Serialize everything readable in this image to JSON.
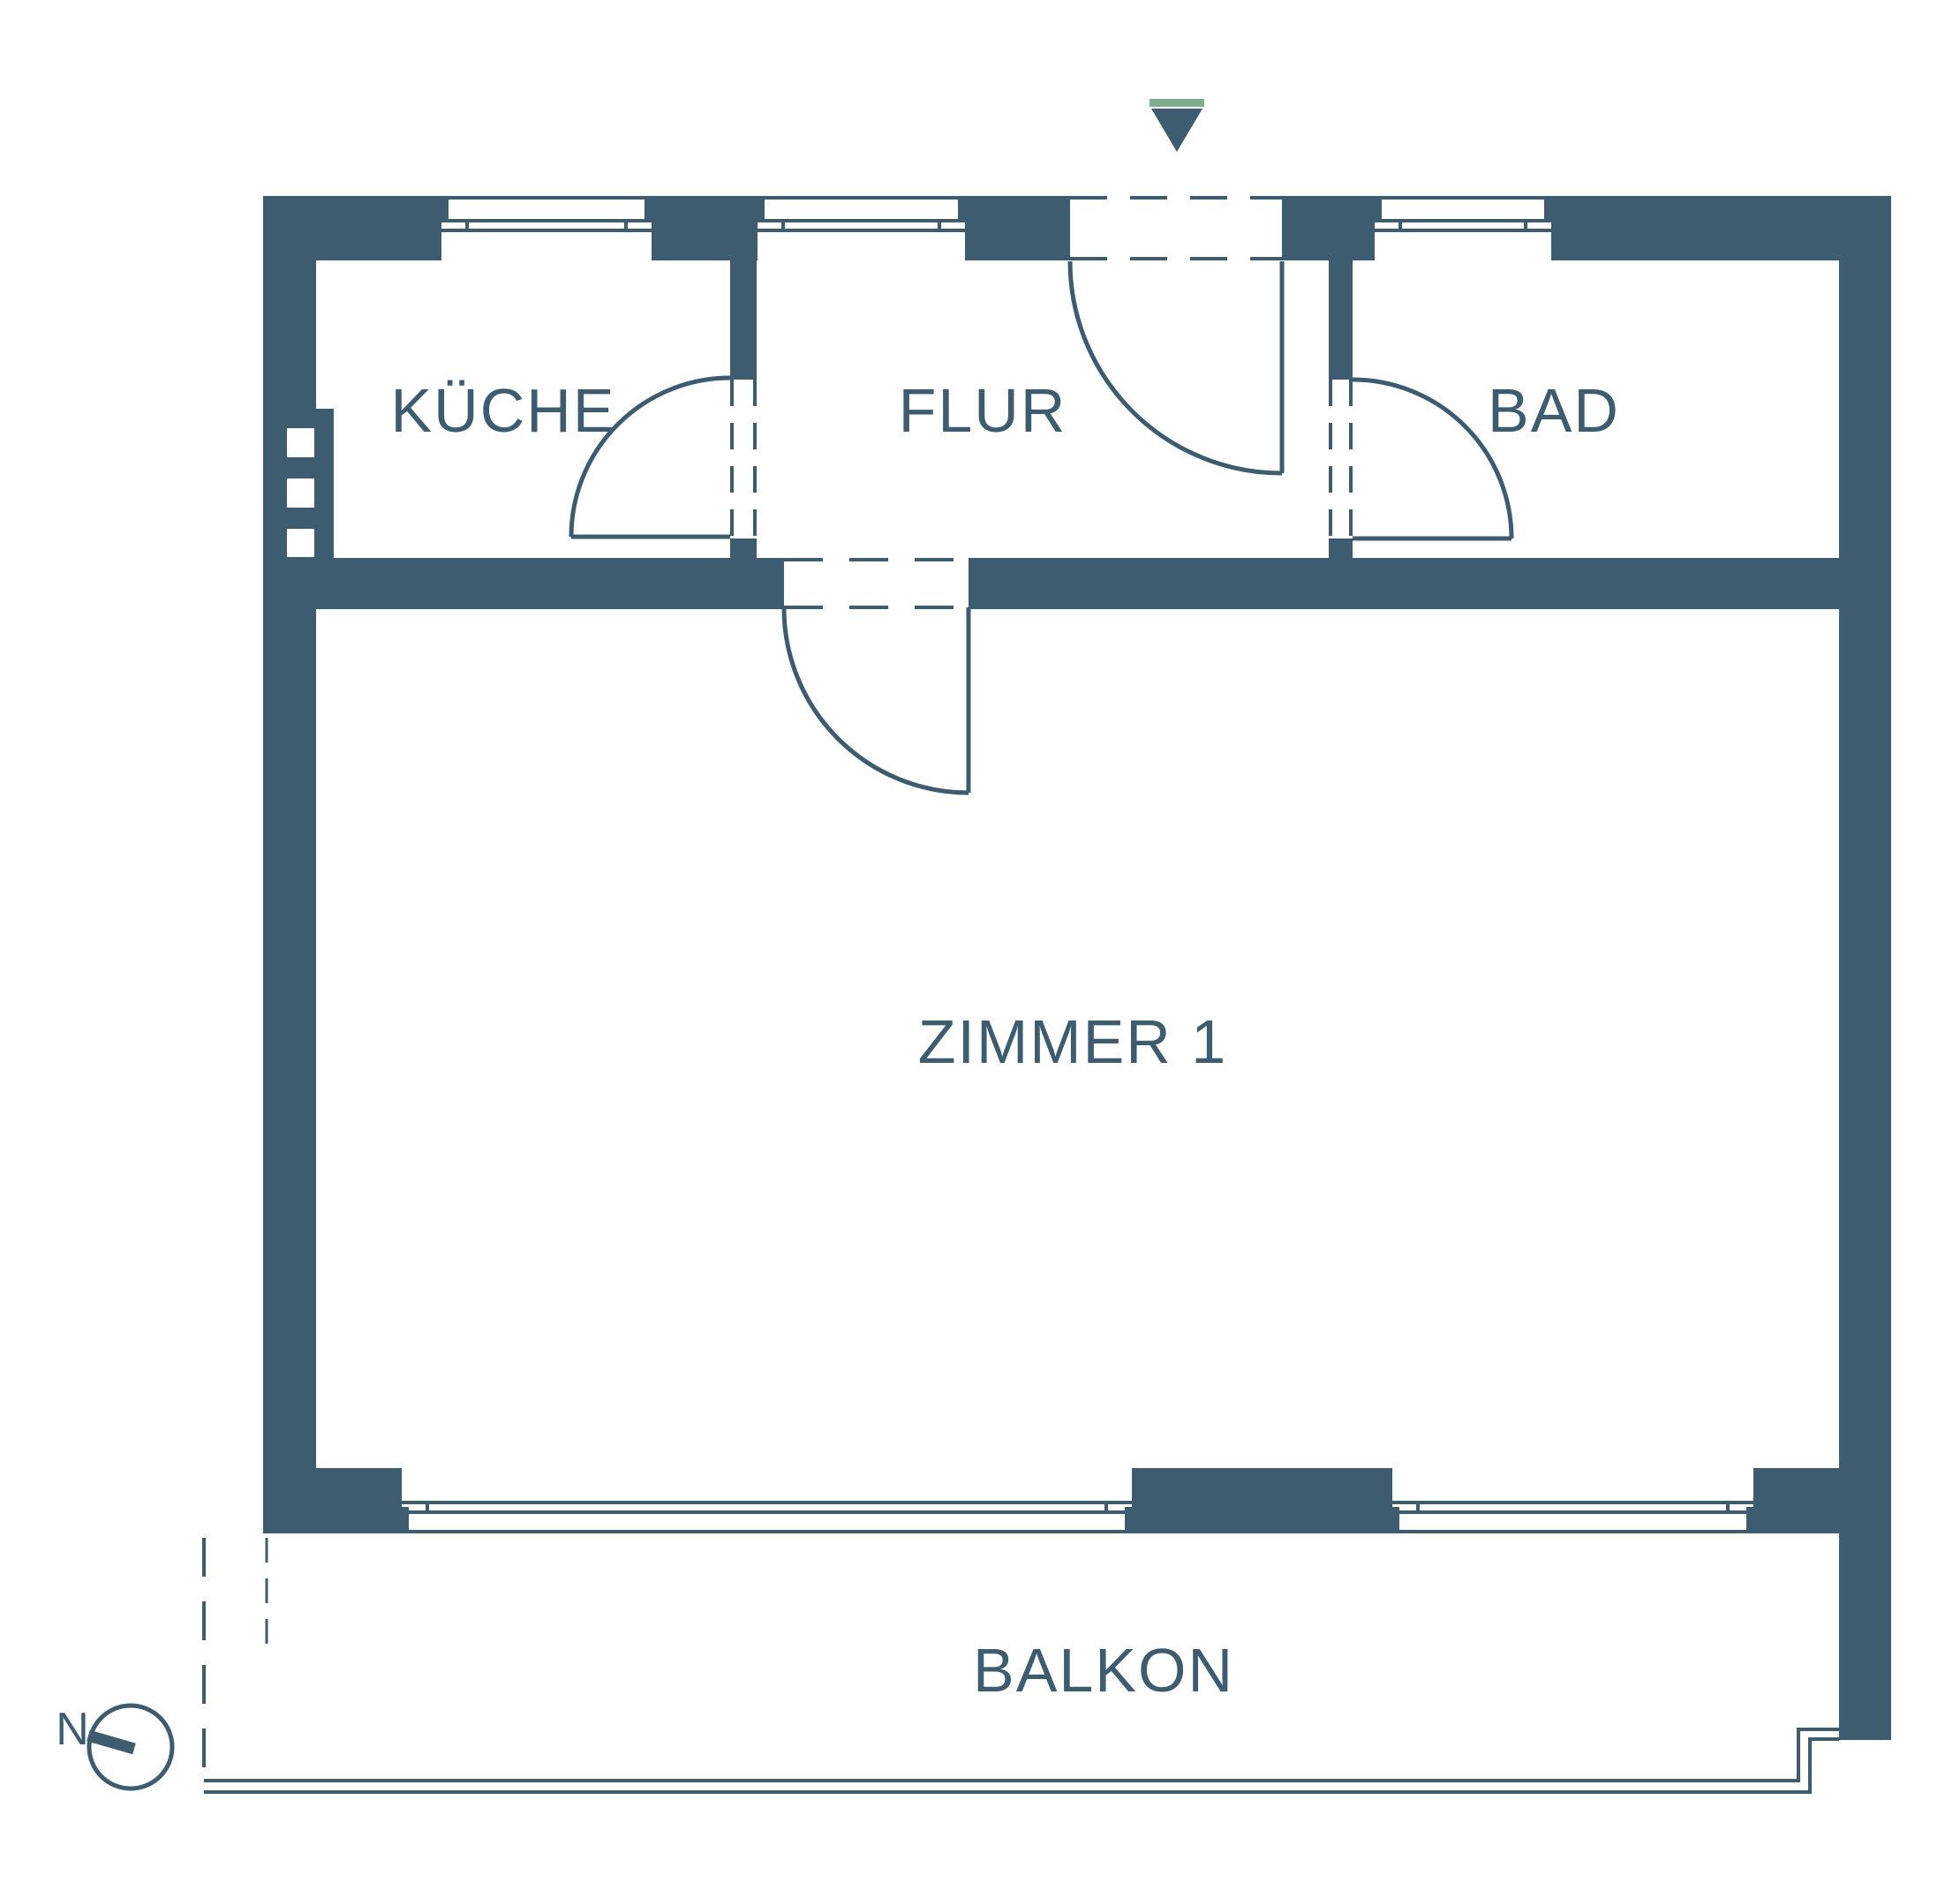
{
  "colors": {
    "wall": "#3d5c6f",
    "green": "#7fae8e",
    "background": "#ffffff"
  },
  "labels": {
    "kueche": "KÜCHE",
    "flur": "FLUR",
    "bad": "BAD",
    "zimmer1": "ZIMMER 1",
    "balkon": "BALKON",
    "compass_north": "N"
  },
  "icons": {
    "entrance_arrow": "entrance-arrow-icon",
    "compass": "north-compass-icon"
  }
}
